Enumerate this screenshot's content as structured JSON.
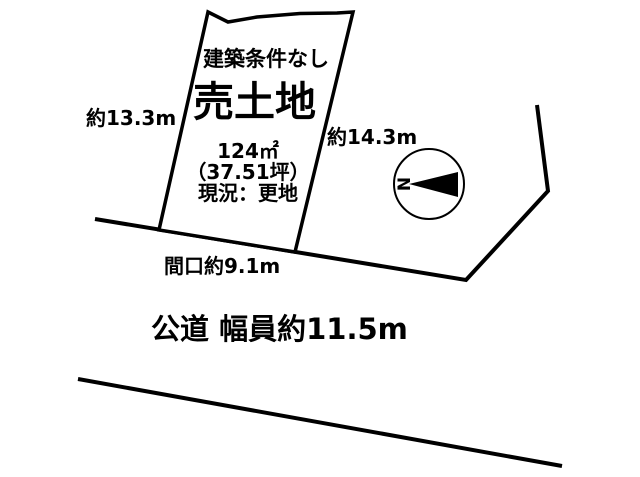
{
  "colors": {
    "background": "#ffffff",
    "line": "#000000",
    "text": "#000000"
  },
  "plot": {
    "condition_label": "建築条件なし",
    "sale_label": "売土地",
    "area_m2": "124㎡",
    "area_tsubo": "（37.51坪）",
    "current_status": "現況：更地"
  },
  "dimensions": {
    "left_side": "約13.3m",
    "right_side": "約14.3m",
    "frontage": "間口約9.1m"
  },
  "road": {
    "label": "公道 幅員約11.5m"
  },
  "compass": {
    "north_label": "N"
  }
}
